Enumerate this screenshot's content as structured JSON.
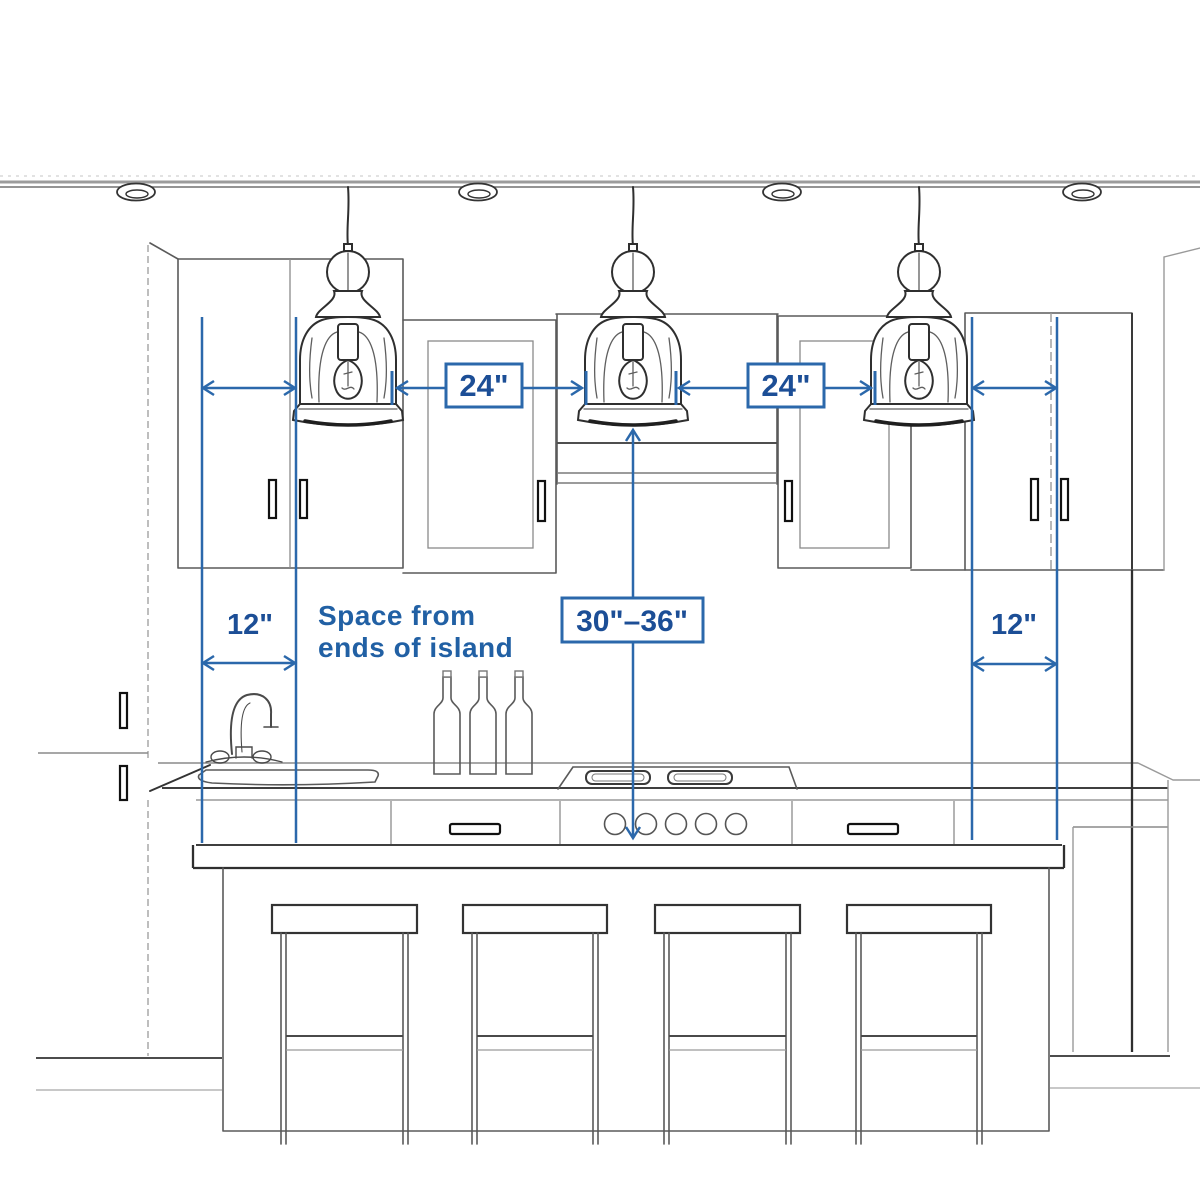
{
  "labels": {
    "spacing_left": "24\"",
    "spacing_right": "24\"",
    "hang_height": "30\"–36\"",
    "end_left": "12\"",
    "end_right": "12\"",
    "note_line1": "Space from",
    "note_line2": "ends of island"
  },
  "colors": {
    "dimension_line": "#2b68ab",
    "label_text": "#1c4e96",
    "sketch": "#4a4a4a",
    "background": "#ffffff"
  },
  "scene": {
    "pendant_lights": 3,
    "recessed_lights": 4,
    "bar_stools": 4,
    "wine_bottles": 3,
    "cooktop_knobs": 5
  }
}
